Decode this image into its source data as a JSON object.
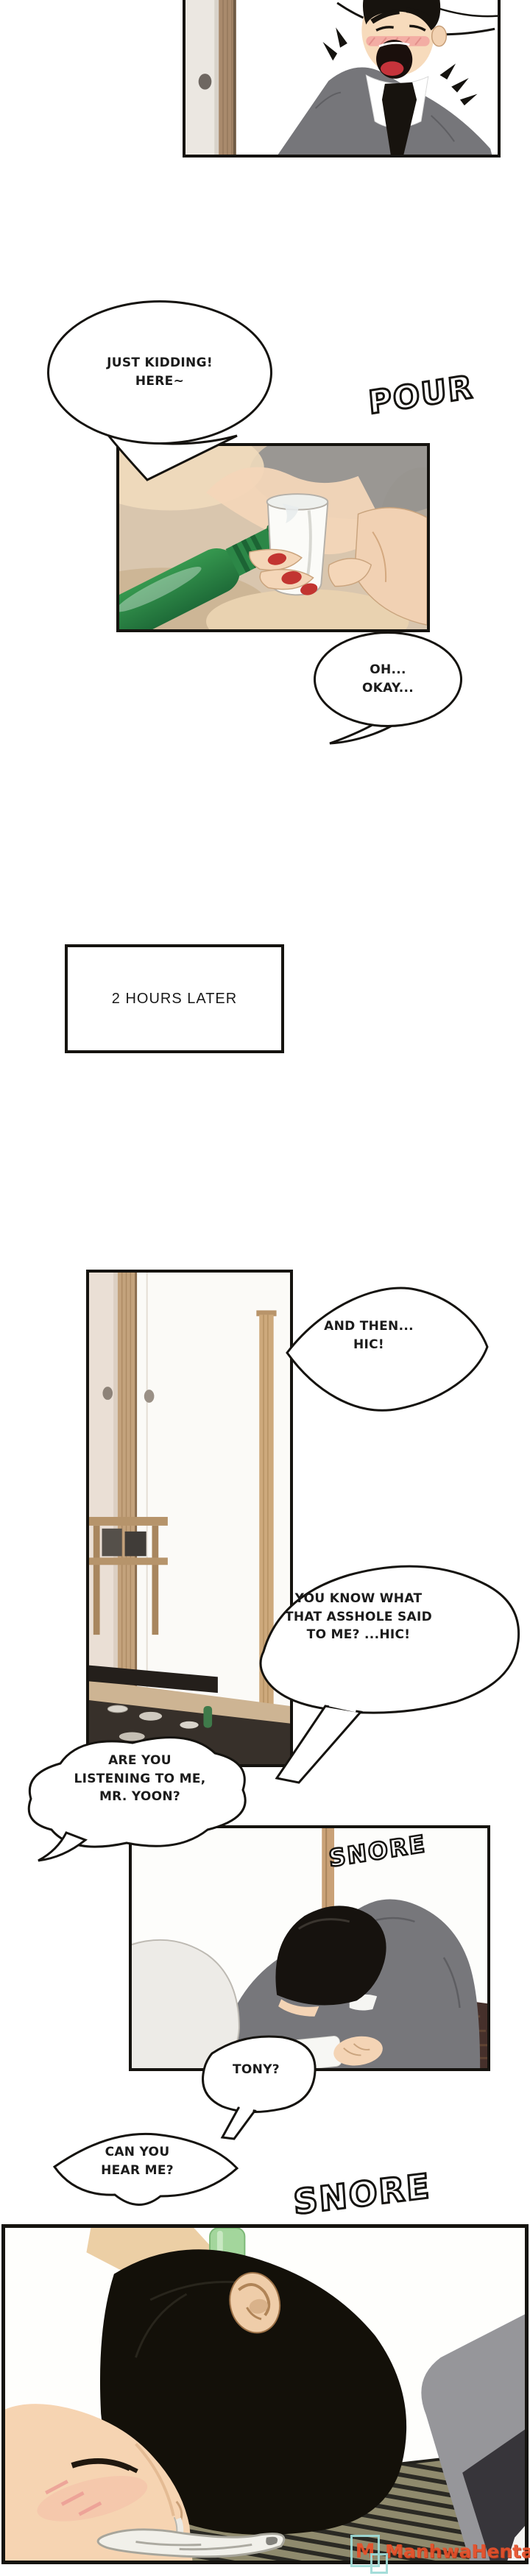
{
  "caption": {
    "text": "2 HOURS LATER"
  },
  "bubbles": {
    "just_kidding": {
      "lines": [
        "JUST KIDDING!",
        "HERE~"
      ]
    },
    "oh_okay": {
      "lines": [
        "OH...",
        "OKAY..."
      ]
    },
    "and_then": {
      "lines": [
        "AND THEN...",
        "HIC!"
      ]
    },
    "you_know": {
      "lines": [
        "YOU KNOW WHAT",
        "THAT ASSHOLE SAID",
        "TO ME? ...HIC!"
      ]
    },
    "listening": {
      "lines": [
        "ARE YOU",
        "LISTENING TO ME,",
        "MR. YOON?"
      ]
    },
    "tony": {
      "lines": [
        "TONY?"
      ]
    },
    "hear_me": {
      "lines": [
        "CAN YOU",
        "HEAR ME?"
      ]
    }
  },
  "sfx": {
    "pour": "POUR",
    "snore_small": "SNORE",
    "snore_big": "SNORE"
  },
  "watermark": {
    "badge": "M",
    "name": "ManhwaHentai"
  },
  "colors": {
    "ink": "#15130f",
    "hair_black": "#16120e",
    "suit_gray": "#77777b",
    "skin": "#f5d6b8",
    "blush_pink": "#f2a7a1",
    "soju_green": "#2c8747",
    "nail_red": "#c23531",
    "mat_olive": "#8f8a6d",
    "mat_dark": "#2a2923",
    "watermark_orange": "#e8502a",
    "watermark_teal": "#9fdcd8"
  }
}
